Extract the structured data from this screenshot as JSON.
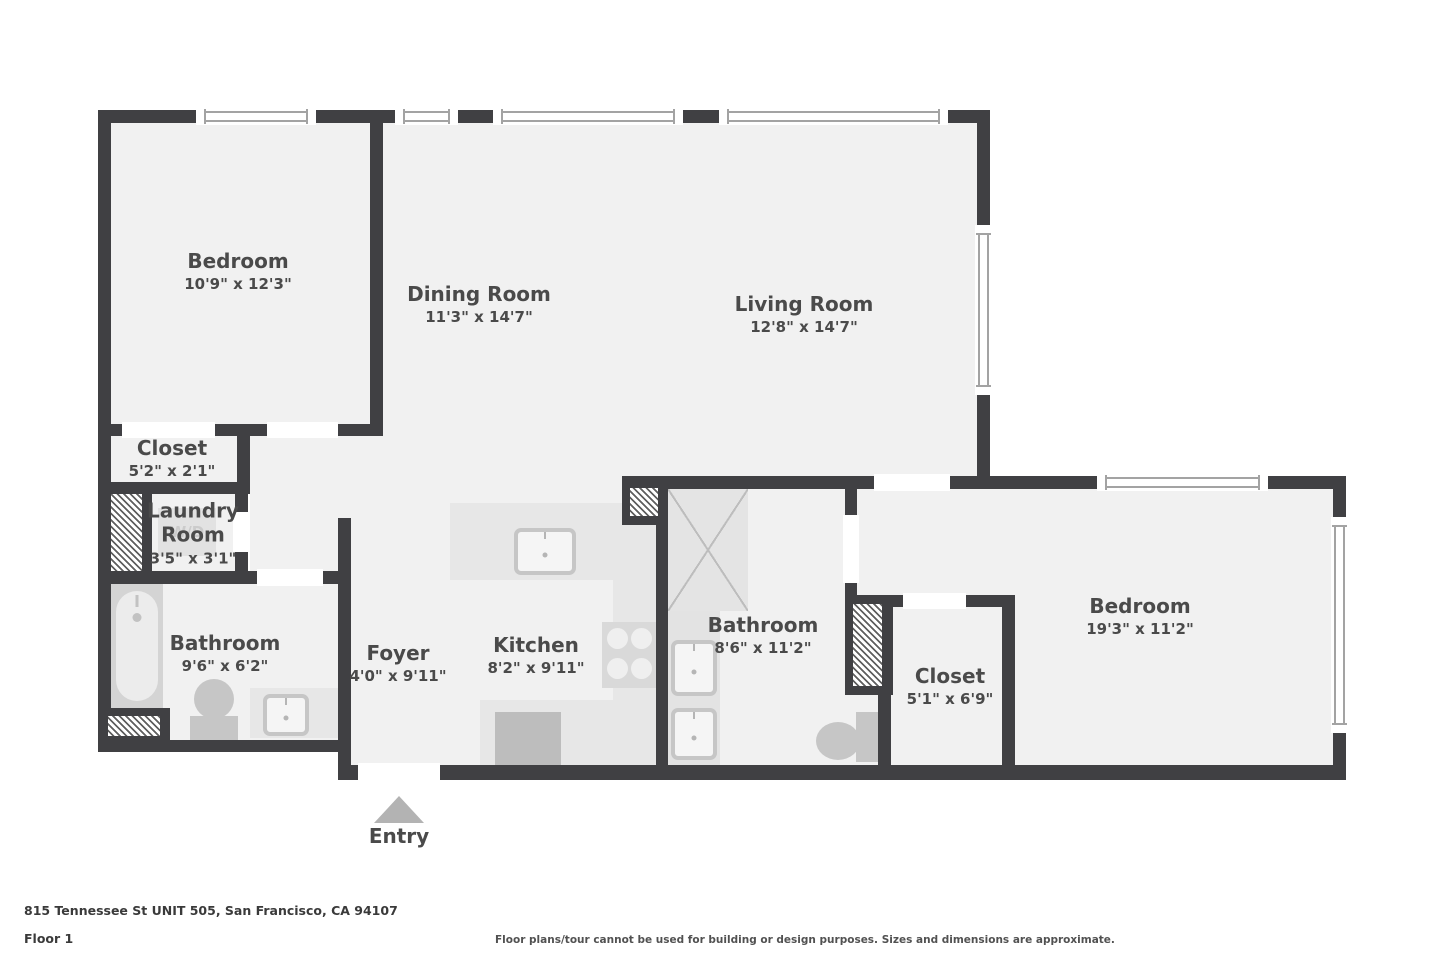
{
  "meta": {
    "address": "815 Tennessee St UNIT 505, San Francisco, CA 94107",
    "floor_label": "Floor 1",
    "disclaimer": "Floor plans/tour cannot be used for building or design purposes. Sizes and dimensions are approximate."
  },
  "entry": {
    "label": "Entry"
  },
  "laundry_appliance": {
    "label": "W/D"
  },
  "rooms": [
    {
      "id": "bedroom-1",
      "name": "Bedroom",
      "dims": "10'9\" x 12'3\""
    },
    {
      "id": "dining",
      "name": "Dining Room",
      "dims": "11'3\" x 14'7\""
    },
    {
      "id": "living",
      "name": "Living Room",
      "dims": "12'8\" x 14'7\""
    },
    {
      "id": "closet-1",
      "name": "Closet",
      "dims": "5'2\" x 2'1\""
    },
    {
      "id": "laundry",
      "name": "Laundry Room",
      "dims": "3'5\" x 3'1\""
    },
    {
      "id": "bathroom-1",
      "name": "Bathroom",
      "dims": "9'6\" x 6'2\""
    },
    {
      "id": "foyer",
      "name": "Foyer",
      "dims": "4'0\" x 9'11\""
    },
    {
      "id": "kitchen",
      "name": "Kitchen",
      "dims": "8'2\" x 9'11\""
    },
    {
      "id": "bathroom-2",
      "name": "Bathroom",
      "dims": "8'6\" x 11'2\""
    },
    {
      "id": "closet-2",
      "name": "Closet",
      "dims": "5'1\" x 6'9\""
    },
    {
      "id": "bedroom-2",
      "name": "Bedroom",
      "dims": "19'3\" x 11'2\""
    }
  ],
  "colors": {
    "wall": "#404043",
    "floor": "#f1f1f1",
    "background": "#ffffff",
    "fixture": "#c6c6c6",
    "label_text": "#4a4a4a"
  }
}
